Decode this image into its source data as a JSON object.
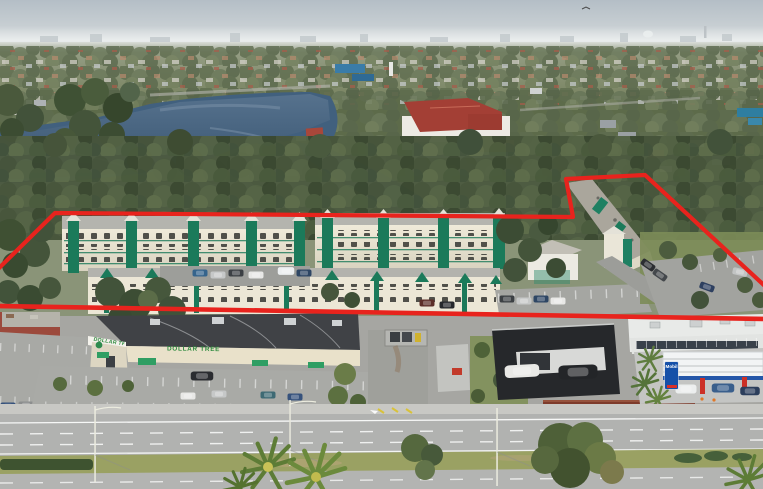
{
  "image": {
    "kind": "aerial-drone-photograph",
    "width": 763,
    "height": 489,
    "subject": "garden-style apartment community outlined in red, lake behind, retail strip and highway in front"
  },
  "signs": {
    "dollar_tree": "DOLLAR TREE",
    "mobil": "Mobil"
  },
  "annotation": {
    "kind": "property-boundary-outline",
    "color": "#e8231d"
  },
  "palette": {
    "boundary_red": "#e8231d",
    "apartment_green": "#1b7a5a",
    "apartment_wall": "#eae5d3",
    "water_blue": "#41607e",
    "dollar_tree_green": "#2e8b3e",
    "mobil_blue": "#1550a8",
    "tree_canopy": "#4c5c3e",
    "road_gray": "#b0b1af",
    "sky_gray": "#bdc6cb"
  }
}
